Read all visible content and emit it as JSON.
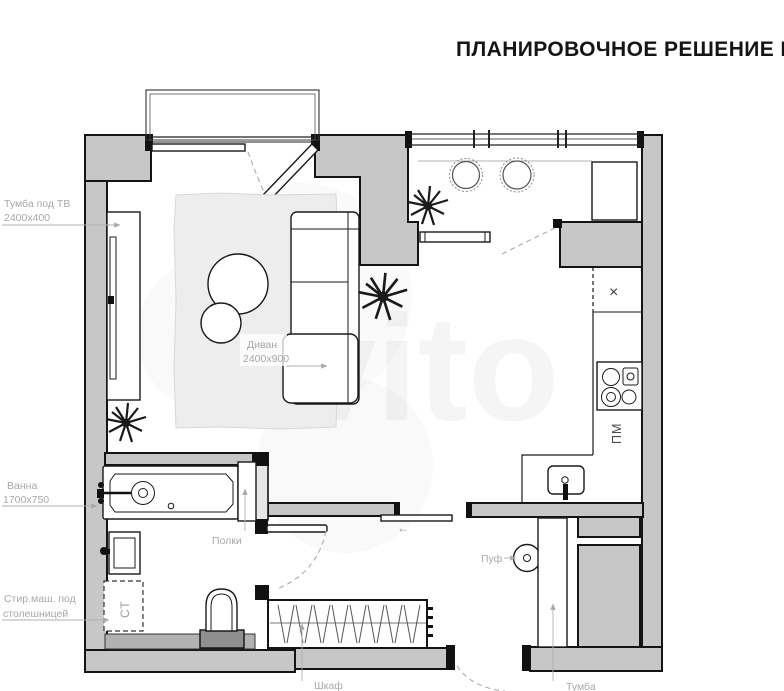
{
  "title": "ПЛАНИРОВОЧНОЕ РЕШЕНИЕ №",
  "watermark": "Avito",
  "colors": {
    "wall_fill": "#c7c7c7",
    "outline": "#141414",
    "label_gray": "#a8a8a8",
    "rug_fill": "#ededed",
    "platform_gray": "#b2b2b2"
  },
  "annotations": {
    "tv_stand": {
      "line1": "Тумба под ТВ",
      "line2": "2400х400"
    },
    "sofa": {
      "line1": "Диван",
      "line2": "2400х900"
    },
    "bath": {
      "line1": "Ванна",
      "line2": "1700х750"
    },
    "shelves": {
      "label": "Полки"
    },
    "washing_machine": {
      "line1": "Стир.маш. под",
      "line2": "столешницей",
      "abbr": "СТ"
    },
    "pouf": {
      "label": "Пуф"
    },
    "wardrobe": {
      "label": "Шкаф"
    },
    "cabinet": {
      "label": "Тумба"
    },
    "dishwasher": {
      "abbr": "ПМ"
    },
    "symbols": {
      "cross": "×",
      "slide_arrow": "←"
    }
  }
}
